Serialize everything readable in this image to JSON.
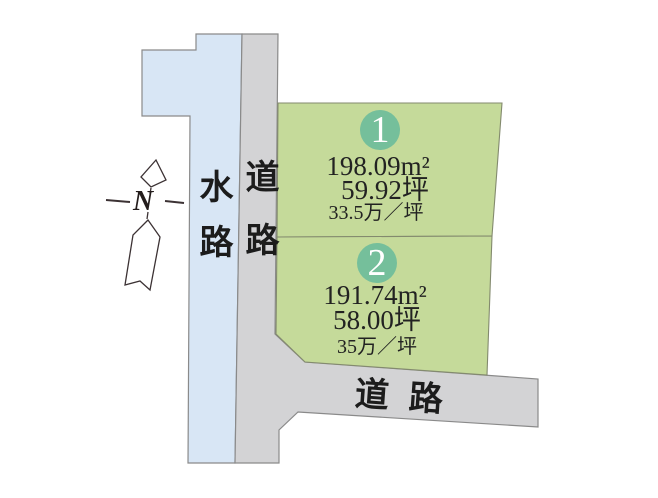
{
  "compass": {
    "label": "N"
  },
  "waterway": {
    "label": "水路"
  },
  "road_vertical": {
    "label": "道路"
  },
  "road_horizontal": {
    "label": "道路"
  },
  "plots": [
    {
      "number": "1",
      "area_m2": "198.09m²",
      "area_tsubo": "59.92坪",
      "unit_price": "33.5万／坪"
    },
    {
      "number": "2",
      "area_m2": "191.74m²",
      "area_tsubo": "58.00坪",
      "unit_price": "35万／坪"
    }
  ],
  "colors": {
    "waterway": "#d8e6f5",
    "road": "#d3d3d5",
    "plot": "#c5da9a",
    "badge": "#75bf9b",
    "outline": "#8a8a8a",
    "text": "#1f1f1f"
  }
}
